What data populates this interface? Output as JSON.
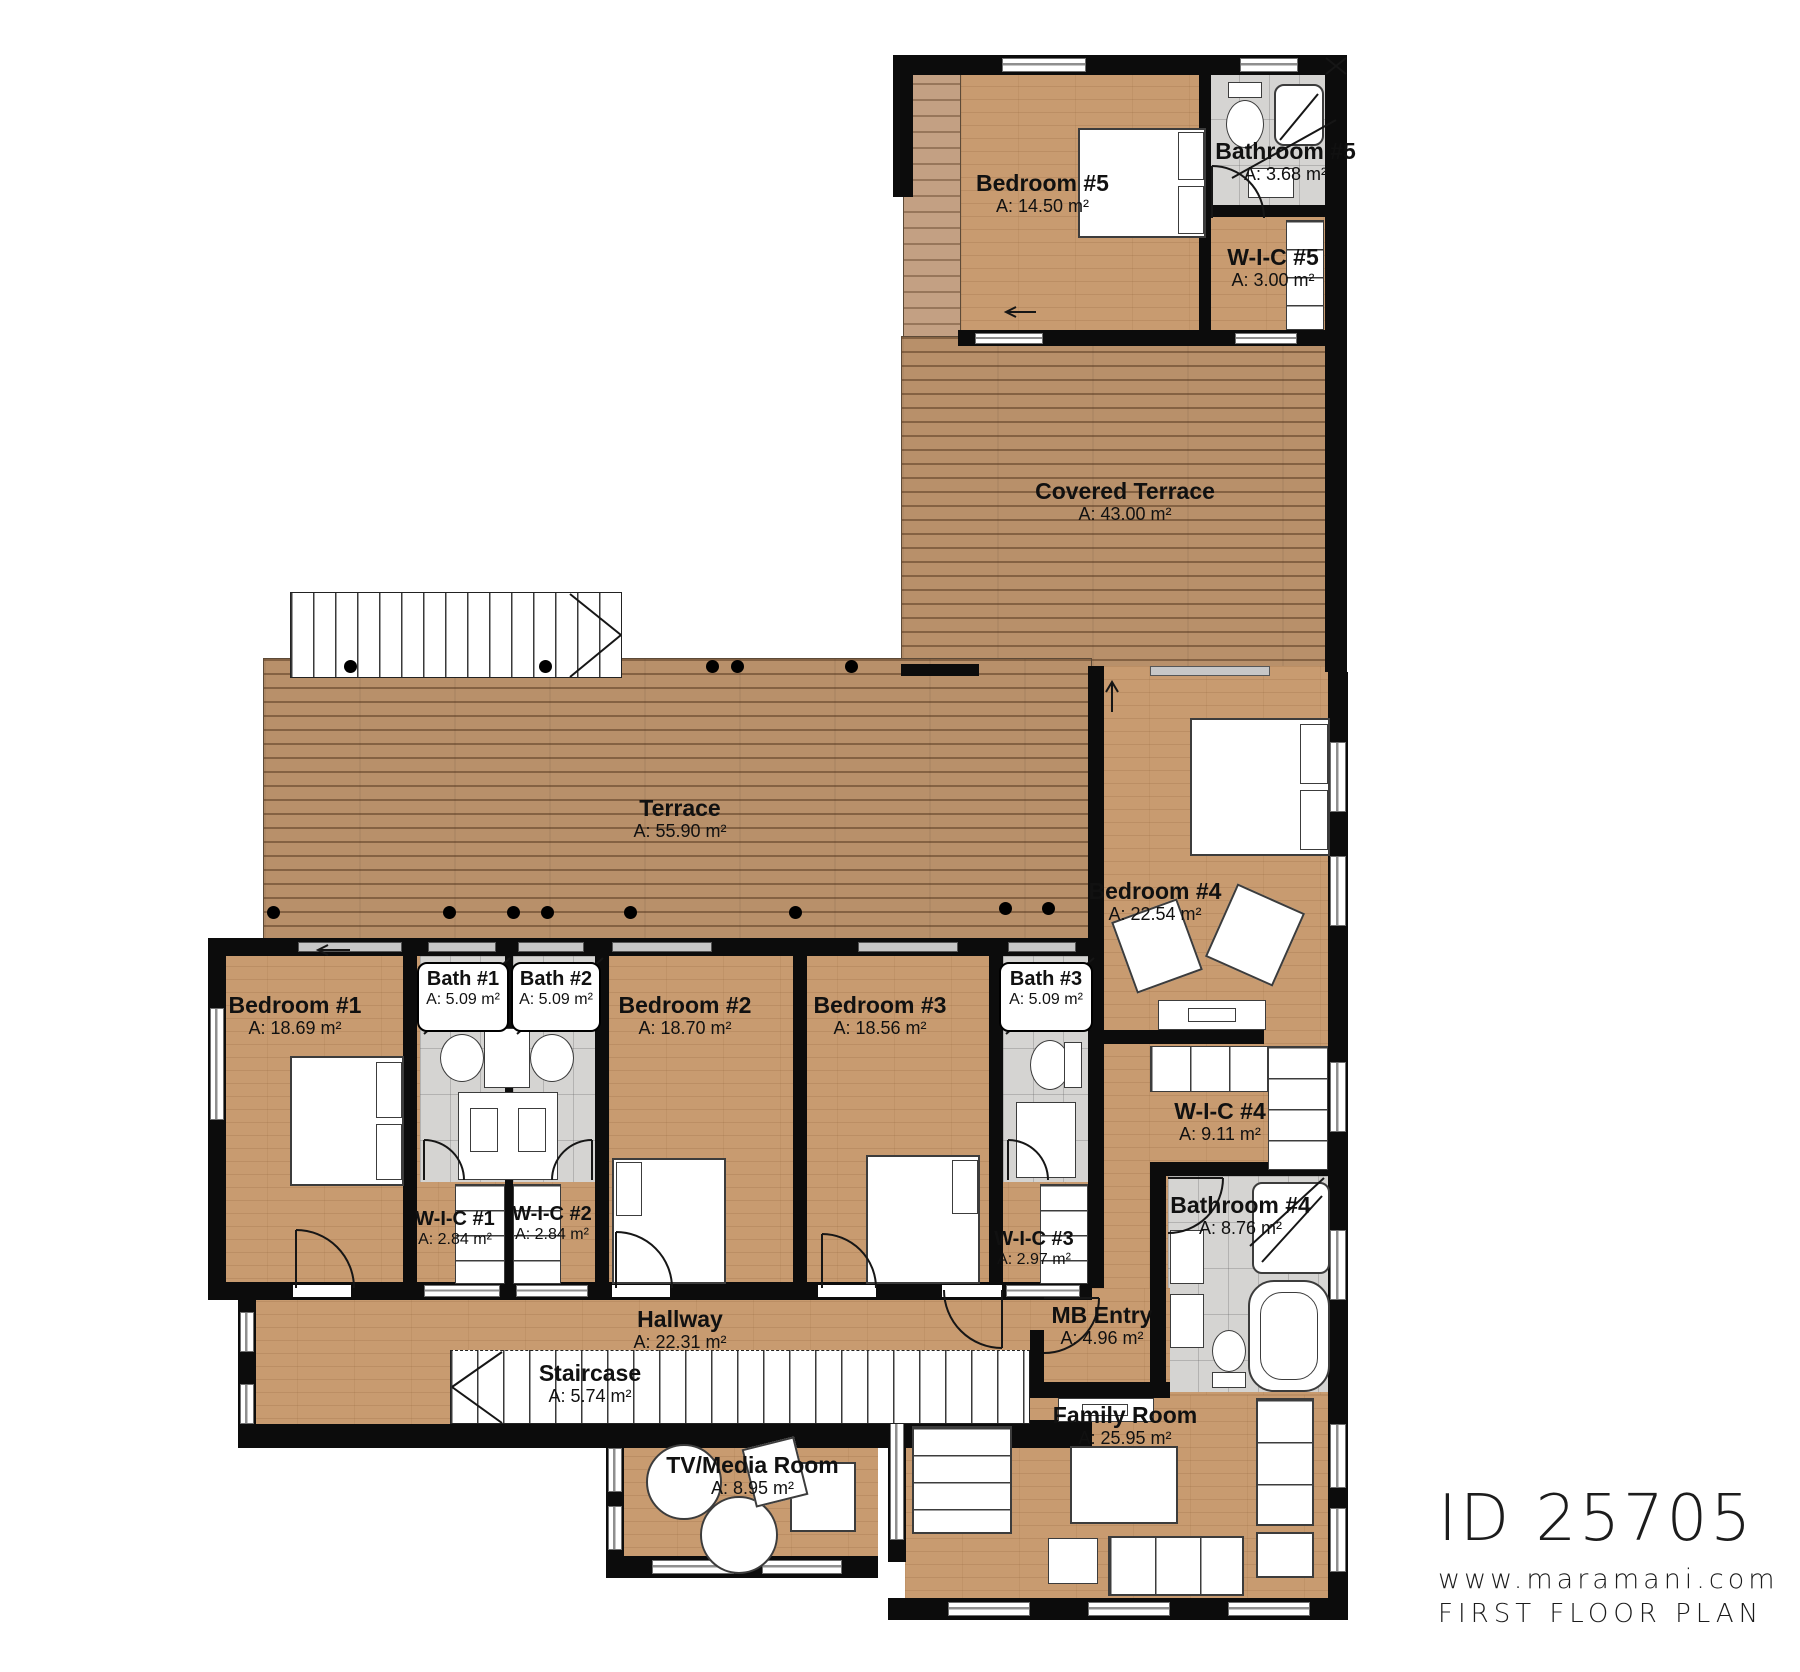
{
  "plan": {
    "rooms": {
      "bedroom5": {
        "name": "Bedroom #5",
        "area": "A: 14.50 m²"
      },
      "bathroom5": {
        "name": "Bathroom #5",
        "area": "A: 3.68 m²"
      },
      "wic5": {
        "name": "W-I-C  #5",
        "area": "A: 3.00 m²"
      },
      "covered_terrace": {
        "name": "Covered Terrace",
        "area": "A: 43.00 m²"
      },
      "terrace": {
        "name": "Terrace",
        "area": "A: 55.90 m²"
      },
      "bedroom4": {
        "name": "Bedroom #4",
        "area": "A: 22.54 m²"
      },
      "wic4": {
        "name": "W-I-C #4",
        "area": "A: 9.11 m²"
      },
      "bathroom4": {
        "name": "Bathroom #4",
        "area": "A: 8.76 m²"
      },
      "bedroom1": {
        "name": "Bedroom #1",
        "area": "A: 18.69 m²"
      },
      "bath1": {
        "name": "Bath #1",
        "area": "A: 5.09 m²"
      },
      "bath2": {
        "name": "Bath #2",
        "area": "A: 5.09 m²"
      },
      "bedroom2": {
        "name": "Bedroom #2",
        "area": "A: 18.70 m²"
      },
      "bedroom3": {
        "name": "Bedroom #3",
        "area": "A: 18.56 m²"
      },
      "bath3": {
        "name": "Bath #3",
        "area": "A: 5.09 m²"
      },
      "wic1": {
        "name": "W-I-C #1",
        "area": "A: 2.84 m²"
      },
      "wic2": {
        "name": "W-I-C #2",
        "area": "A: 2.84 m²"
      },
      "wic3": {
        "name": "W-I-C #3",
        "area": "A: 2.97 m²"
      },
      "hallway": {
        "name": "Hallway",
        "area": "A: 22.31 m²"
      },
      "staircase": {
        "name": "Staircase",
        "area": "A: 5.74 m²"
      },
      "mb_entry": {
        "name": "MB Entry",
        "area": "A: 4.96 m²"
      },
      "family_room": {
        "name": "Family Room",
        "area": "A: 25.95 m²"
      },
      "tv_media": {
        "name": "TV/Media Room",
        "area": "A: 8.95 m²"
      }
    },
    "titleblock": {
      "id": "ID 25705",
      "website": "www.maramani.com",
      "plan_name": "FIRST FLOOR PLAN"
    },
    "colors": {
      "wood_floor": "#c89b70",
      "deck": "#b8906a",
      "tile": "#d5d4d2",
      "wall": "#0c0c0c",
      "background": "#ffffff"
    }
  }
}
